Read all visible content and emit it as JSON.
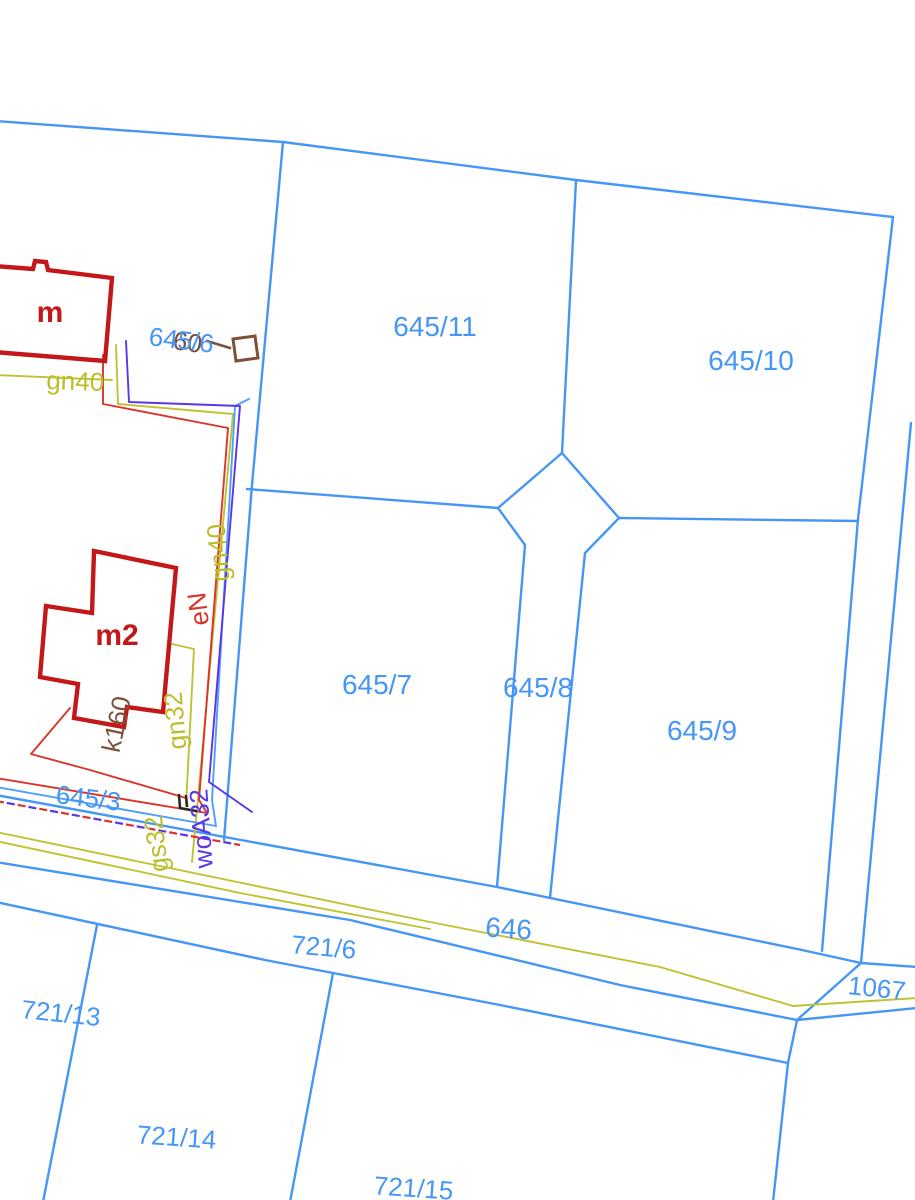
{
  "map": {
    "parcel_labels": {
      "p645_6": "645/6",
      "p645_3": "645/3",
      "p645_7": "645/7",
      "p645_8": "645/8",
      "p645_9": "645/9",
      "p645_10": "645/10",
      "p645_11": "645/11",
      "p646": "646",
      "p721_6": "721/6",
      "p721_13": "721/13",
      "p721_14": "721/14",
      "p721_15": "721/15",
      "p1067": "1067"
    },
    "building_labels": {
      "m": "m",
      "m2": "m2"
    },
    "utility_labels": {
      "gn40_h": "gn40",
      "gn40_v": "gn40",
      "gn32": "gn32",
      "gs32": "gs32",
      "eN": "eN",
      "woA32": "woA32",
      "k160": "k160",
      "k60": "60"
    },
    "colors": {
      "parcel_blue": "#4596f7",
      "building_red": "#c4171a",
      "cable_red": "#d9352a",
      "water_blue": "#4aa0fb",
      "violet": "#5b35e8",
      "utility_yellow": "#c0c232",
      "brown": "#7d5038",
      "marker_black": "#2e2620",
      "background": "#ffffff"
    }
  }
}
